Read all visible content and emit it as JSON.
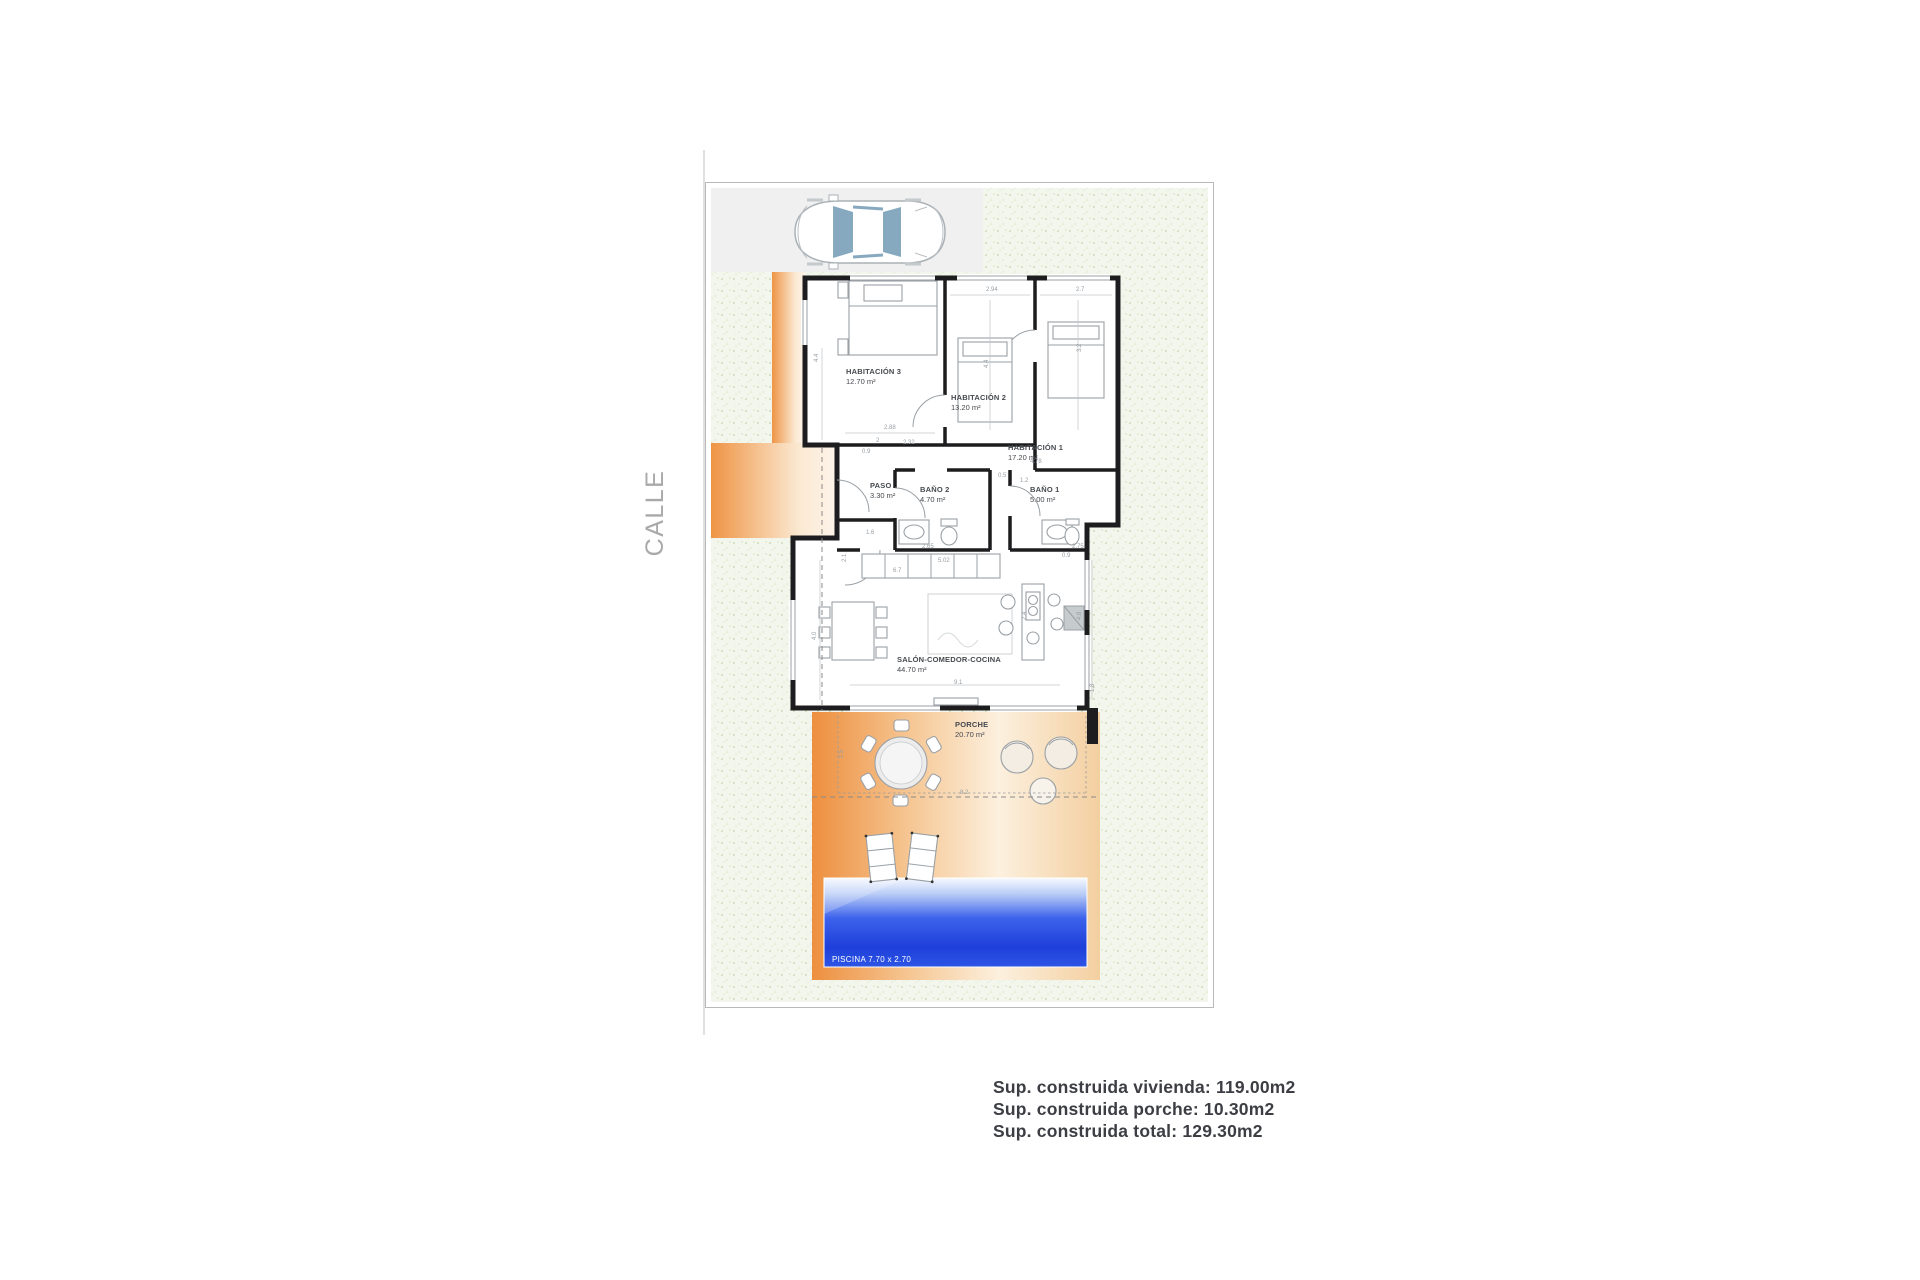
{
  "street_label": "CALLE",
  "summary": {
    "line1": "Sup. construida vivienda: 119.00m2",
    "line2": "Sup. construida porche: 10.30m2",
    "line3": "Sup. construida total: 129.30m2"
  },
  "rooms": {
    "hab3": {
      "name": "HABITACIÓN 3",
      "area": "12.70 m²"
    },
    "hab2": {
      "name": "HABITACIÓN 2",
      "area": "13.20 m²"
    },
    "hab1": {
      "name": "HABITACIÓN 1",
      "area": "17.20 m²"
    },
    "paso": {
      "name": "PASO",
      "area": "3.30 m²"
    },
    "bano2": {
      "name": "BAÑO 2",
      "area": "4.70 m²"
    },
    "bano1": {
      "name": "BAÑO 1",
      "area": "5.00 m²"
    },
    "salon": {
      "name": "SALÓN-COMEDOR-COCINA",
      "area": "44.70 m²"
    },
    "porche": {
      "name": "PORCHE",
      "area": "20.70 m²"
    }
  },
  "pool": {
    "label": "PISCINA 7.70 x 2.70"
  },
  "colors": {
    "wall": "#1d1d1f",
    "accent_orange": "#ef9243",
    "pool_blue": "#2b50e3",
    "garden_green": "#f3f6ec",
    "driveway_gray": "#f0f0f1"
  },
  "dimensions": [
    {
      "t": "2.94",
      "x": 986,
      "y": 291
    },
    {
      "t": "2.7",
      "x": 1076,
      "y": 291
    },
    {
      "t": "4.4",
      "x": 818,
      "y": 362,
      "r": -90
    },
    {
      "t": "4.4",
      "x": 988,
      "y": 368,
      "r": -90
    },
    {
      "t": "3.2",
      "x": 1081,
      "y": 352,
      "r": -90
    },
    {
      "t": "2.88",
      "x": 884,
      "y": 429
    },
    {
      "t": "2",
      "x": 876,
      "y": 442
    },
    {
      "t": "2.32",
      "x": 903,
      "y": 444
    },
    {
      "t": "0.9",
      "x": 862,
      "y": 453
    },
    {
      "t": "4.78",
      "x": 1030,
      "y": 463
    },
    {
      "t": "1.2",
      "x": 1020,
      "y": 482
    },
    {
      "t": "0.5",
      "x": 998,
      "y": 477
    },
    {
      "t": "1.6",
      "x": 866,
      "y": 534
    },
    {
      "t": "2.65",
      "x": 922,
      "y": 548
    },
    {
      "t": "2.75",
      "x": 1072,
      "y": 548
    },
    {
      "t": "2.1",
      "x": 846,
      "y": 562,
      "r": -90
    },
    {
      "t": "6.7",
      "x": 893,
      "y": 572
    },
    {
      "t": "5.02",
      "x": 938,
      "y": 562
    },
    {
      "t": "0.9",
      "x": 1062,
      "y": 557
    },
    {
      "t": "4.8",
      "x": 1081,
      "y": 620,
      "r": -90
    },
    {
      "t": "2.4",
      "x": 1026,
      "y": 620,
      "r": -90
    },
    {
      "t": "4.0",
      "x": 816,
      "y": 640,
      "r": -90
    },
    {
      "t": "9.1",
      "x": 954,
      "y": 684
    },
    {
      "t": "1.8",
      "x": 1094,
      "y": 692,
      "r": -90
    },
    {
      "t": "2.5",
      "x": 843,
      "y": 758,
      "r": -90
    },
    {
      "t": "8.2",
      "x": 960,
      "y": 794
    }
  ]
}
